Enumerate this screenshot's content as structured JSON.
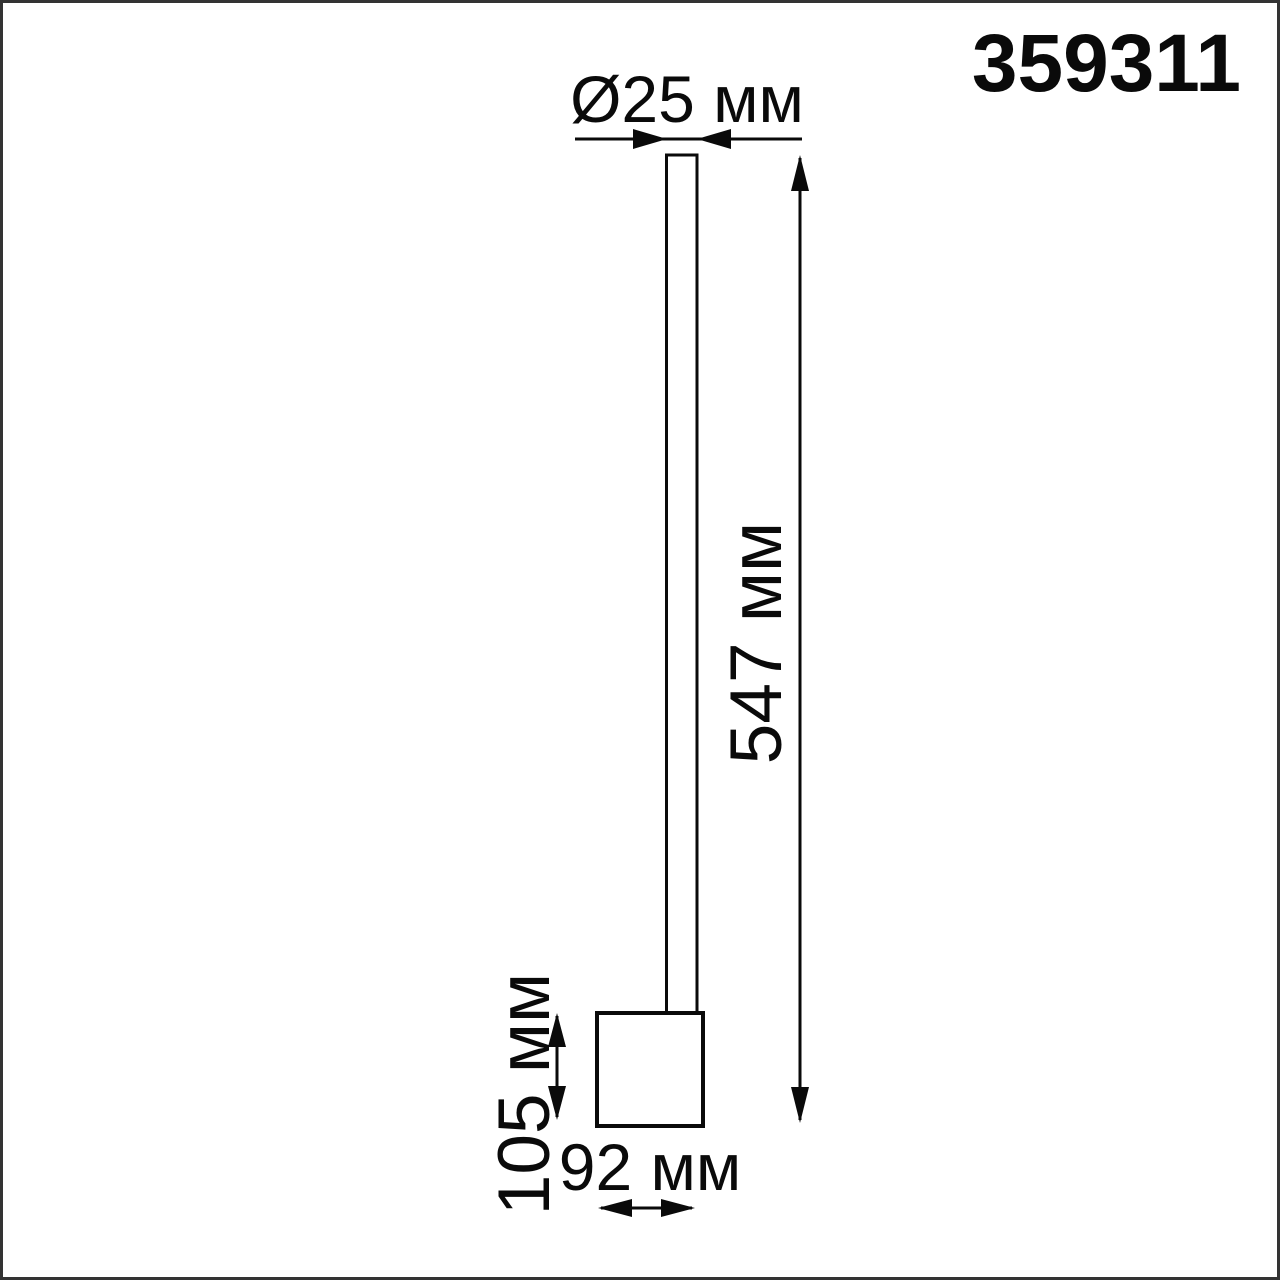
{
  "product_code": "359311",
  "dimensions": {
    "diameter_label": "Ø25 мм",
    "height_label": "547 мм",
    "base_height_label": "105 мм",
    "base_width_label": "92 мм"
  },
  "drawing": {
    "description_parts": [
      "lamp-tube",
      "lamp-base"
    ],
    "units": "мм"
  },
  "colors": {
    "line": "#0a0a0a",
    "frame_border": "#333333",
    "background": "#ffffff"
  }
}
